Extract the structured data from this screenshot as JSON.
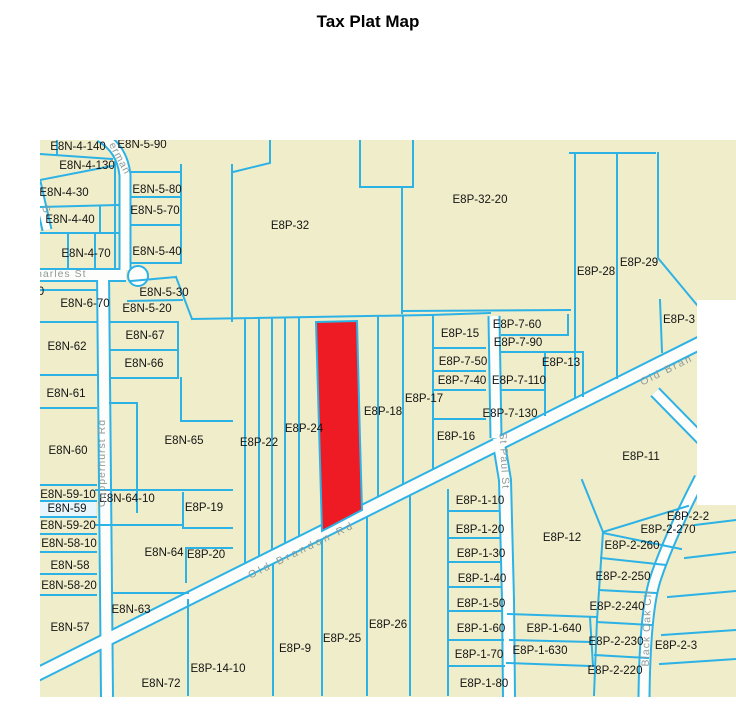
{
  "title": "Tax Plat Map",
  "map": {
    "colors": {
      "background": "#f0edca",
      "parcel_line": "#2db2e6",
      "road_fill": "#fdfdfb",
      "highlight_red": "#ee1b24",
      "selected_fill": "#e6f6fc",
      "parcel_text": "#141414",
      "road_text": "#8f9a96"
    },
    "highlighted_parcel": {
      "description": "red highlighted parcel between E8P-24 and E8P-18 above Old Brandon Rd"
    },
    "selected_parcel": {
      "id": "E8N-59"
    },
    "parcel_labels": [
      {
        "text": "E8N-4-140",
        "x": 78,
        "y": 150
      },
      {
        "text": "E8N-5-90",
        "x": 142,
        "y": 148
      },
      {
        "text": "E8N-4-130",
        "x": 87,
        "y": 169
      },
      {
        "text": "E8N-4-30",
        "x": 64,
        "y": 196
      },
      {
        "text": "E8N-5-80",
        "x": 157,
        "y": 193
      },
      {
        "text": "E8N-4-40",
        "x": 70,
        "y": 223
      },
      {
        "text": "E8N-5-70",
        "x": 155,
        "y": 214
      },
      {
        "text": "E8N-4-70",
        "x": 86,
        "y": 257
      },
      {
        "text": "E8N-5-40",
        "x": 157,
        "y": 255
      },
      {
        "text": "E8P-32",
        "x": 290,
        "y": 229
      },
      {
        "text": "E8P-32-20",
        "x": 480,
        "y": 203
      },
      {
        "text": "E8P-28",
        "x": 596,
        "y": 275
      },
      {
        "text": "E8P-29",
        "x": 639,
        "y": 266
      },
      {
        "text": "E8P-3",
        "x": 679,
        "y": 323
      },
      {
        "text": "E8N-6-70",
        "x": 85,
        "y": 307
      },
      {
        "text": "E8N-5-30",
        "x": 164,
        "y": 296
      },
      {
        "text": "E8N-5-20",
        "x": 147,
        "y": 312
      },
      {
        "text": "0",
        "x": 41,
        "y": 295
      },
      {
        "text": "E8N-67",
        "x": 145,
        "y": 339
      },
      {
        "text": "E8N-62",
        "x": 67,
        "y": 350
      },
      {
        "text": "E8N-66",
        "x": 144,
        "y": 367
      },
      {
        "text": "E8N-61",
        "x": 66,
        "y": 397
      },
      {
        "text": "E8P-15",
        "x": 460,
        "y": 337
      },
      {
        "text": "E8P-7-60",
        "x": 517,
        "y": 328
      },
      {
        "text": "E8P-7-90",
        "x": 518,
        "y": 346
      },
      {
        "text": "E8P-7-50",
        "x": 463,
        "y": 365
      },
      {
        "text": "E8P-13",
        "x": 561,
        "y": 366
      },
      {
        "text": "E8P-7-40",
        "x": 462,
        "y": 384
      },
      {
        "text": "E8P-7-110",
        "x": 519,
        "y": 384
      },
      {
        "text": "E8P-17",
        "x": 424,
        "y": 402
      },
      {
        "text": "E8P-18",
        "x": 383,
        "y": 415
      },
      {
        "text": "E8P-7-130",
        "x": 510,
        "y": 417
      },
      {
        "text": "E8N-60",
        "x": 68,
        "y": 454
      },
      {
        "text": "E8N-65",
        "x": 184,
        "y": 444
      },
      {
        "text": "E8P-22",
        "x": 259,
        "y": 446
      },
      {
        "text": "E8P-24",
        "x": 304,
        "y": 432
      },
      {
        "text": "E8P-16",
        "x": 456,
        "y": 440
      },
      {
        "text": "E8P-11",
        "x": 641,
        "y": 460
      },
      {
        "text": "E8N-59-10",
        "x": 68,
        "y": 498
      },
      {
        "text": "E8N-64-10",
        "x": 127,
        "y": 502
      },
      {
        "text": "E8N-59",
        "x": 67,
        "y": 512
      },
      {
        "text": "E8P-19",
        "x": 204,
        "y": 511
      },
      {
        "text": "E8N-59-20",
        "x": 68,
        "y": 529
      },
      {
        "text": "E8P-1-10",
        "x": 480,
        "y": 504
      },
      {
        "text": "E8N-58-10",
        "x": 69,
        "y": 547
      },
      {
        "text": "E8P-1-20",
        "x": 480,
        "y": 533
      },
      {
        "text": "E8P-12",
        "x": 562,
        "y": 541
      },
      {
        "text": "E8P-2-2",
        "x": 688,
        "y": 520
      },
      {
        "text": "E8P-2-270",
        "x": 668,
        "y": 533
      },
      {
        "text": "E8P-2-260",
        "x": 632,
        "y": 549
      },
      {
        "text": "E8N-58",
        "x": 70,
        "y": 569
      },
      {
        "text": "E8N-64",
        "x": 164,
        "y": 556
      },
      {
        "text": "E8P-20",
        "x": 206,
        "y": 558
      },
      {
        "text": "E8P-1-30",
        "x": 481,
        "y": 557
      },
      {
        "text": "E8N-58-20",
        "x": 69,
        "y": 589
      },
      {
        "text": "E8P-1-40",
        "x": 482,
        "y": 582
      },
      {
        "text": "E8P-2-250",
        "x": 623,
        "y": 580
      },
      {
        "text": "E8N-63",
        "x": 131,
        "y": 613
      },
      {
        "text": "E8P-1-50",
        "x": 481,
        "y": 607
      },
      {
        "text": "E8P-2-240",
        "x": 617,
        "y": 610
      },
      {
        "text": "E8N-57",
        "x": 70,
        "y": 631
      },
      {
        "text": "E8P-1-60",
        "x": 481,
        "y": 632
      },
      {
        "text": "E8P-1-640",
        "x": 554,
        "y": 632
      },
      {
        "text": "E8P-2-230",
        "x": 616,
        "y": 645
      },
      {
        "text": "E8P-2-3",
        "x": 676,
        "y": 649
      },
      {
        "text": "E8P-1-630",
        "x": 540,
        "y": 654
      },
      {
        "text": "E8P-1-70",
        "x": 479,
        "y": 658
      },
      {
        "text": "E8P-2-220",
        "x": 615,
        "y": 674
      },
      {
        "text": "E8P-26",
        "x": 388,
        "y": 628
      },
      {
        "text": "E8P-25",
        "x": 342,
        "y": 642
      },
      {
        "text": "E8P-9",
        "x": 295,
        "y": 652
      },
      {
        "text": "E8P-14-10",
        "x": 218,
        "y": 672
      },
      {
        "text": "E8N-72",
        "x": 161,
        "y": 687
      },
      {
        "text": "E8P-1-80",
        "x": 484,
        "y": 687
      }
    ],
    "road_labels": [
      {
        "text": "Charles St",
        "x": 57,
        "y": 277,
        "rot": 0,
        "ls": 1
      },
      {
        "text": "erman",
        "x": 117,
        "y": 160,
        "rot": 62,
        "ls": 1
      },
      {
        "text": "S",
        "x": 43,
        "y": 210,
        "rot": 70,
        "ls": 0
      },
      {
        "text": "Copperhurst Rd",
        "x": 105,
        "y": 463,
        "rot": -90,
        "ls": 1
      },
      {
        "text": "Old Brandon Rd",
        "x": 303,
        "y": 553,
        "rot": -26,
        "ls": 3
      },
      {
        "text": "Old Bran",
        "x": 668,
        "y": 373,
        "rot": -26,
        "ls": 2
      },
      {
        "text": "St Paul St",
        "x": 501,
        "y": 461,
        "rot": 87,
        "ls": 1
      },
      {
        "text": "Black Oak Cir",
        "x": 650,
        "y": 628,
        "rot": -88,
        "ls": 1
      }
    ]
  }
}
